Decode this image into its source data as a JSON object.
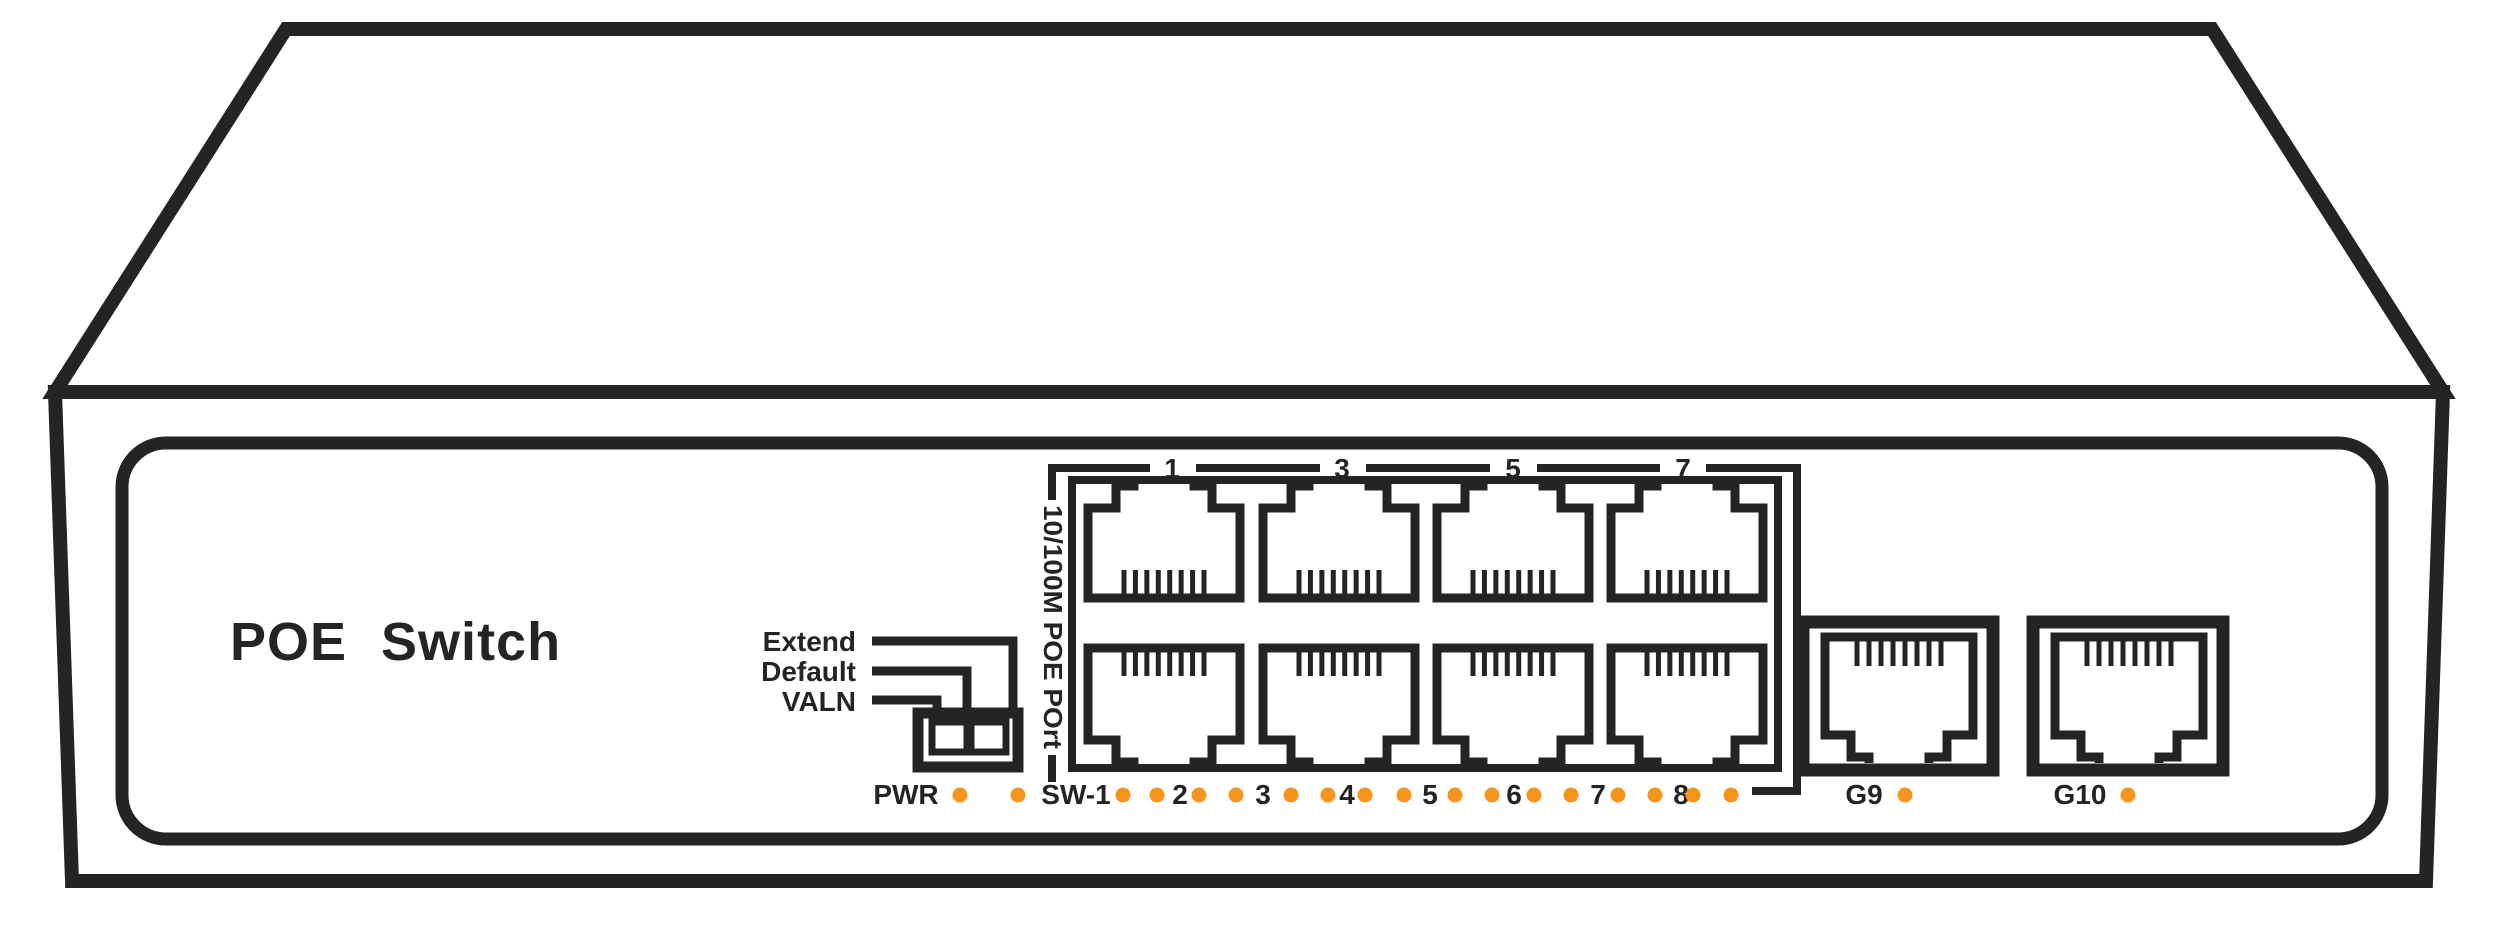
{
  "device": {
    "title": "POE Switch"
  },
  "colors": {
    "line": "#242424",
    "led_dot": "#F7941D",
    "background": "#FFFFFF"
  },
  "dip": {
    "labels": [
      "Extend",
      "Default",
      "VALN"
    ],
    "positions": 2
  },
  "poe_block": {
    "vertical_label": "10/100M POE POrt",
    "top_port_numbers": [
      "1",
      "3",
      "5",
      "7"
    ],
    "num_ports": 8
  },
  "led_row": {
    "labels": [
      {
        "text": "PWR",
        "x": 906
      },
      {
        "text": "SW-1",
        "x": 1076
      },
      {
        "text": "2",
        "x": 1180
      },
      {
        "text": "3",
        "x": 1263
      },
      {
        "text": "4",
        "x": 1347
      },
      {
        "text": "5",
        "x": 1430
      },
      {
        "text": "6",
        "x": 1514
      },
      {
        "text": "7",
        "x": 1598
      },
      {
        "text": "8",
        "x": 1681
      }
    ],
    "dots_x": [
      960,
      1018,
      1123,
      1157,
      1199,
      1236,
      1291,
      1328,
      1365,
      1404,
      1455,
      1492,
      1534,
      1571,
      1618,
      1655,
      1693,
      1731
    ]
  },
  "uplink_ports": [
    {
      "label": "G9",
      "label_x": 1864,
      "dot_x": 1905,
      "frame_x": 1803,
      "cx": 1899
    },
    {
      "label": "G10",
      "label_x": 2080,
      "dot_x": 2128,
      "frame_x": 2033,
      "cx": 2129
    }
  ],
  "geometry": {
    "poe_port_centers_x": [
      1164,
      1339,
      1513,
      1687
    ]
  }
}
